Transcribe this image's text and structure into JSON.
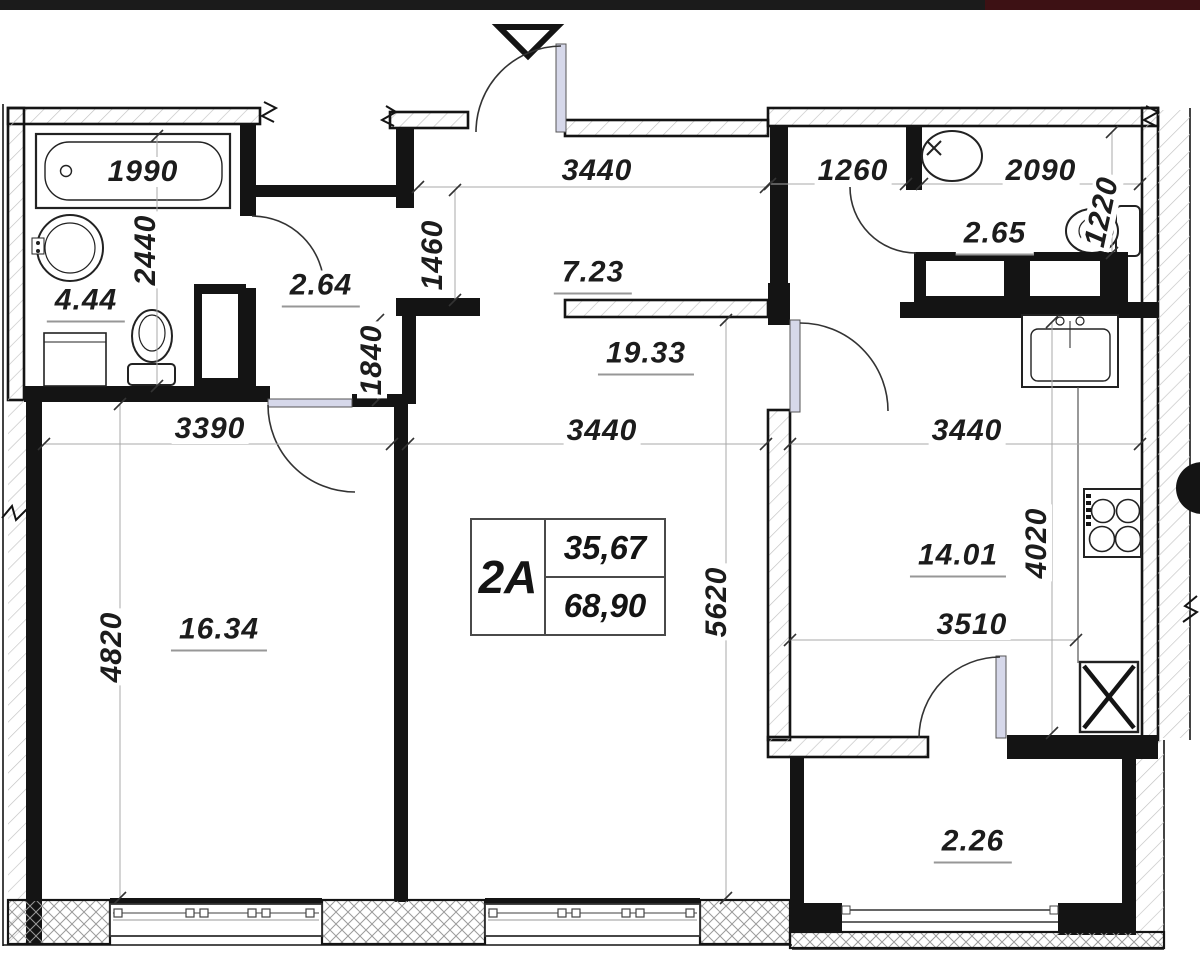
{
  "drawing": {
    "type": "apartment floor plan"
  },
  "unit": {
    "code": "2A",
    "living_area": "35,67",
    "total_area": "68,90"
  },
  "dimensions": {
    "bathtub_length": "1990",
    "bathroom_width": "2440",
    "bedroom_width": "3390",
    "bedroom_length": "4820",
    "corridor_width": "1460",
    "hall_length": "1840",
    "corridor_length": "3440",
    "living_width": "3440",
    "living_length": "5620",
    "closet_width": "1260",
    "wc_width": "2090",
    "wc_depth": "1220",
    "kitchen_width": "3440",
    "kitchen_depth": "4020",
    "kitchen_inner_width": "3510"
  },
  "areas": {
    "bathroom": "4.44",
    "hall": "2.64",
    "corridor": "7.23",
    "living_room": "19.33",
    "wc": "2.65",
    "kitchen": "14.01",
    "bedroom": "16.34",
    "balcony": "2.26"
  }
}
